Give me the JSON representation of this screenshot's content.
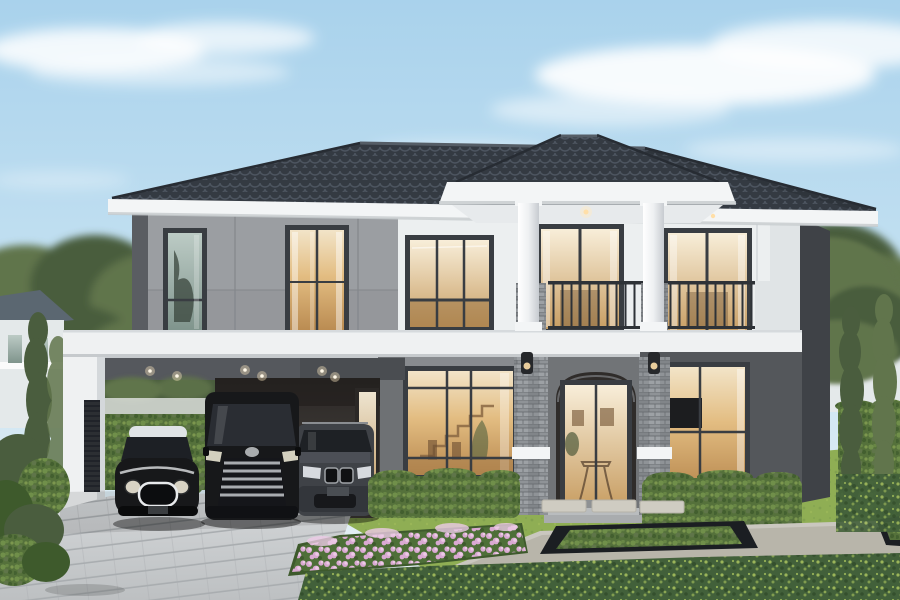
{
  "scene": {
    "type": "architectural-exterior-render",
    "subject": "front view of a modern two-story luxury house at dusk",
    "elements": [
      "sky with soft clouds",
      "background trees",
      "neighboring houses",
      "main house with hip tile roof",
      "portico with round white columns",
      "balconies with dark metal railings",
      "stacked-stone entry piers",
      "wall sconces",
      "carport with three parked cars",
      "paved driveway",
      "hedges",
      "lawn",
      "pink flower bed",
      "sunken planter",
      "groundcover"
    ]
  },
  "house": {
    "stories": 2,
    "roof": "dark tiled hip roof",
    "facade_finishes": [
      "white render",
      "gray panel cladding",
      "stacked stone"
    ],
    "lighting": [
      "warm interior light in windows",
      "recessed soffit downlights",
      "entry sconces"
    ]
  },
  "carport": {
    "cars": [
      {
        "name": "mini-hatchback",
        "body": "black",
        "roof": "white"
      },
      {
        "name": "luxury-minivan",
        "body": "black",
        "grille": "chrome"
      },
      {
        "name": "suv",
        "body": "dark gray"
      }
    ],
    "downlight_count": 6
  },
  "garden": {
    "features": [
      "trimmed hedges",
      "cypress trees",
      "stepping stones",
      "concrete terrace",
      "black-rimmed sunken planter",
      "pink flower bed",
      "foreground groundcover"
    ]
  },
  "colors": {
    "sky_top": "#a9d2ec",
    "sky_mid": "#c8e3f2",
    "sky_horizon": "#eaf2f5",
    "cloud": "#ffffff",
    "tree_dark": "#4a5d3e",
    "tree_mid": "#61754c",
    "tree_light": "#7d9160",
    "neighbor_wall": "#e4e9ea",
    "neighbor_roof": "#5b6771",
    "fence_wall": "#dadedb",
    "roof_tile": "#343a42",
    "roof_tile_hl": "#4d5560",
    "roof_edge": "#272c33",
    "fascia_white": "#f3f5f6",
    "soffit": "#e7eaec",
    "fascia_shadow": "#c6cacd",
    "wall_white": "#eceff0",
    "wall_white_dim": "#e0e4e6",
    "wall_gray": "#9b9ea2",
    "wall_gray_dark": "#8f9296",
    "trim_dark": "#5a5d62",
    "frame_dark": "#393d42",
    "glass_cool_top": "#bccbc5",
    "glass_cool_bot": "#7f948c",
    "glass_warm_top": "#f2e4c8",
    "glass_warm_mid": "#e3bd82",
    "glass_warm_bot": "#b98a50",
    "door_glass_top": "#f8eed9",
    "door_glass_bot": "#c89e63",
    "interior_top": "#2b2826",
    "interior_bot": "#4c4642",
    "carport_inner": "#55585d",
    "carport_white": "#eff1f2",
    "stone_base": "#8f9397",
    "stone_dark": "#707478",
    "stone_light": "#abafb3",
    "stone_line": "#63676b",
    "railing": "#2e3237",
    "hedge": "#55713b",
    "hedge_light": "#7c9c50",
    "hedge_dark": "#3e5a2c",
    "hedge_fleck": "#a3bd62",
    "lawn": "#8fae54",
    "lawn_shade": "#72934a",
    "ground": "#42603a",
    "ground_fleck": "#aac45e",
    "ground_dark": "#2c4424",
    "flower_base": "#4e6f38",
    "flower_pink": "#d9a9d2",
    "flower_pink_light": "#eccae6",
    "drive_top": "#d5d8da",
    "drive_bot": "#bdc0c2",
    "drive_line": "#a9adb0",
    "concrete": "#b8b5aa",
    "concrete_dark": "#a09d93",
    "planter_black": "#1b1e22",
    "car_black": "#17181a",
    "car_white_roof": "#dfe3e6",
    "car_gray": "#3f4247",
    "chrome": "#c3c7cb",
    "warm_light": "#ffdfa8",
    "glow": "#ffecc4",
    "side_wall": "#3f4247",
    "first_floor_dark": "#54575b",
    "entrance_wall": "#717477",
    "wall_strip": "#888b8f",
    "wall_strip_dark": "#6e7174",
    "door_recess": "#2f2c2a",
    "step_light": "#b9bcbe",
    "step_mid": "#a9acae",
    "stone_pad": "#cfccc2"
  }
}
